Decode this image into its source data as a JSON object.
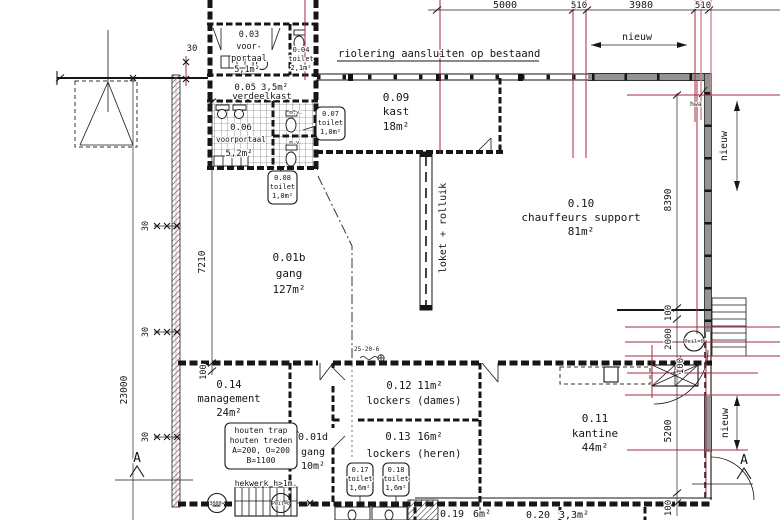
{
  "rooms": {
    "r001b": {
      "number": "0.01b",
      "name": "gang",
      "area": "127m²"
    },
    "r001d": {
      "number": "0.01d",
      "name": "gang",
      "area": "10m²"
    },
    "r003": {
      "number": "0.03",
      "name_line1": "voor-",
      "name_line2": "portaal",
      "area": "5,1m²"
    },
    "r004": {
      "number": "0.04",
      "name": "toilet",
      "area": "2,1m²"
    },
    "r005": {
      "number": "0.05",
      "name": "verdeelkast",
      "area": "3,5m²"
    },
    "r006": {
      "number": "0.06",
      "name": "voorportaal",
      "area": "5,2m²"
    },
    "r007": {
      "number": "0.07",
      "name": "toilet",
      "area": "1,0m²"
    },
    "r008": {
      "number": "0.08",
      "name": "toilet",
      "area": "1,0m²"
    },
    "r009": {
      "number": "0.09",
      "name": "kast",
      "area": "18m²"
    },
    "r010": {
      "number": "0.10",
      "name": "chauffeurs support",
      "area": "81m²"
    },
    "r011": {
      "number": "0.11",
      "name": "kantine",
      "area": "44m²"
    },
    "r012": {
      "number": "0.12",
      "name": "lockers (dames)",
      "area": "11m²"
    },
    "r013": {
      "number": "0.13",
      "name": "lockers (heren)",
      "area": "16m²"
    },
    "r014": {
      "number": "0.14",
      "name": "management",
      "area": "24m²"
    },
    "r017": {
      "number": "0.17",
      "name": "toilet",
      "area": "1,6m²"
    },
    "r018": {
      "number": "0.18",
      "name": "toilet",
      "area": "1,6m²"
    },
    "r019": {
      "number": "0.19",
      "area": "6m²"
    },
    "r020": {
      "number": "0.20",
      "area": "3,3m²"
    }
  },
  "annotations": {
    "riolering": "riolering aansluiten op bestaand",
    "loket_rolluik": "loket + rolluik",
    "hekwerk": "hekwerk h>1m.",
    "hwa": "hwa",
    "mv": "m.v.",
    "marker_25_20_6": "25-20-6",
    "peil": "Peil=0",
    "level_3000": "3000+",
    "section_label": "A"
  },
  "note_box": {
    "line1": "houten trap",
    "line2": "houten treden",
    "line3": "A=200, O=200",
    "line4": "B=1100"
  },
  "dimensions": {
    "d5000": "5000",
    "d510": "510",
    "d3980": "3980",
    "nieuw": "nieuw",
    "d8390": "8390",
    "d2000": "2000",
    "d5200": "5200",
    "d100": "100",
    "d23000": "23000",
    "d7210": "7210",
    "d30": "30"
  }
}
